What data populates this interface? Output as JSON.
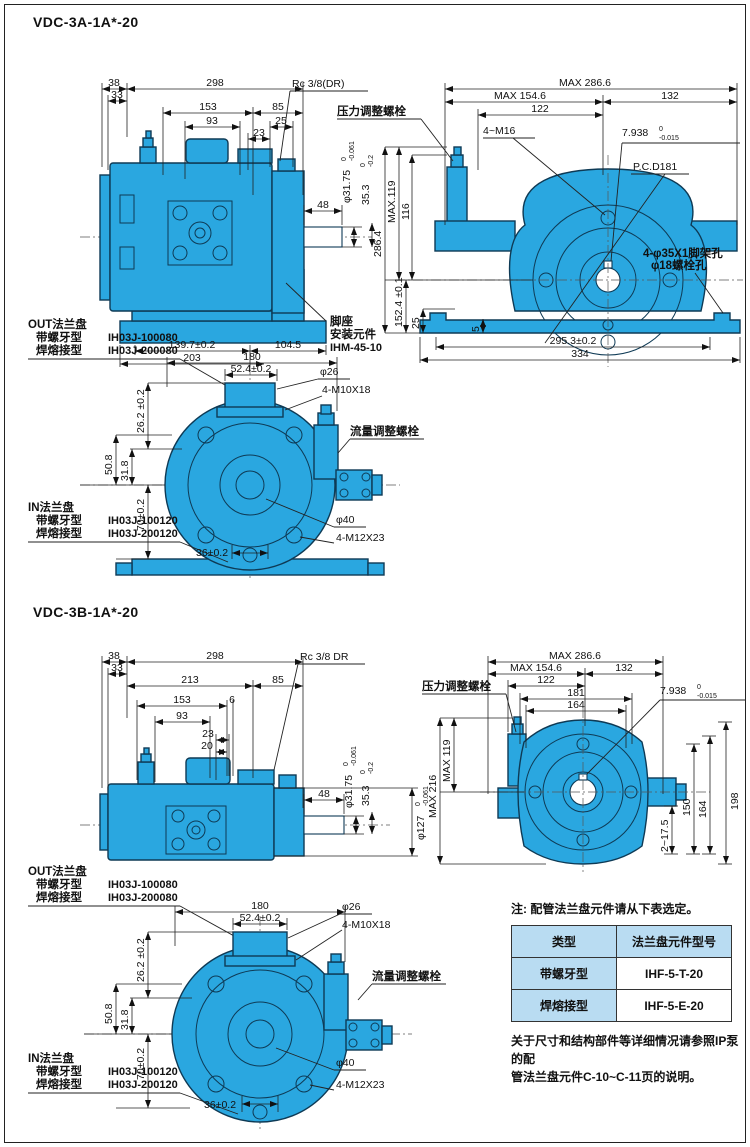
{
  "titles": {
    "t1": "VDC-3A-1A*-20",
    "t2": "VDC-3B-1A*-20"
  },
  "colors": {
    "pump_blue": "#2aa7e0",
    "outline": "#0e3a55",
    "table_header_bg": "#b9dcf2"
  },
  "dims": {
    "d38": "38",
    "d33": "33",
    "d298": "298",
    "d153": "153",
    "d85": "85",
    "d93": "93",
    "d25": "25",
    "d23": "23",
    "d213": "213",
    "d6": "6",
    "d20": "20",
    "rc_a": "Rc 3/8(DR)",
    "rc_b": "Rc 3/8 DR",
    "d48": "48",
    "phi3175": "φ31.75",
    "d353": "35.3",
    "phi127": "φ127",
    "t0": "0",
    "tol061": "-0.061",
    "tol02": "-0.2",
    "tol015": "-0.015",
    "d1397": "139.7±0.2",
    "d203": "203",
    "d1045": "104.5",
    "max2866": "MAX 286.6",
    "max1546": "MAX 154.6",
    "d132": "132",
    "d122": "122",
    "d181": "181",
    "d164": "164",
    "m16": "4~M16",
    "d7938": "7.938",
    "pcd": "P.C.D181",
    "max119": "MAX.119",
    "max119b": "MAX 119",
    "d116": "116",
    "d2864": "286.4",
    "d1524": "152.4 ±0.1",
    "d5": "5",
    "d2953": "295.3±0.2",
    "d334": "334",
    "max216": "MAX 216",
    "d198": "198",
    "d150": "150",
    "d2175": "2~17.5",
    "d180": "180",
    "d524": "52.4±0.2",
    "phi26": "φ26",
    "m10": "4-M10X18",
    "d262": "26.2 ±0.2",
    "d508": "50.8",
    "d318": "31.8",
    "d70": "70±0.2",
    "d36": "36±0.2",
    "phi40": "φ40",
    "m12": "4-M12X23"
  },
  "labels": {
    "pressure": "压力调整螺栓",
    "flow": "流量调整螺栓",
    "foot1": "脚座",
    "foot2": "安装元件",
    "foot3": "IHM-45-10",
    "hole1": "4-φ35X1脚架孔",
    "hole2": "φ18螺栓孔",
    "out": "OUT法兰盘",
    "in": "IN法兰盘",
    "thread": "带螺牙型",
    "weld": "焊熔接型",
    "outc1": "IH03J-100080",
    "outc2": "IH03J-200080",
    "inc1": "IH03J-100120",
    "inc2": "IH03J-200120"
  },
  "note": {
    "head": "注: 配管法兰盘元件请从下表选定。",
    "th1": "类型",
    "th2": "法兰盘元件型号",
    "r1a": "带螺牙型",
    "r1b": "IHF-5-T-20",
    "r2a": "焊熔接型",
    "r2b": "IHF-5-E-20",
    "f1": "关于尺寸和结构部件等详细情况请参照IP泵的配",
    "f2": "管法兰盘元件C-10~C-11页的说明。"
  }
}
